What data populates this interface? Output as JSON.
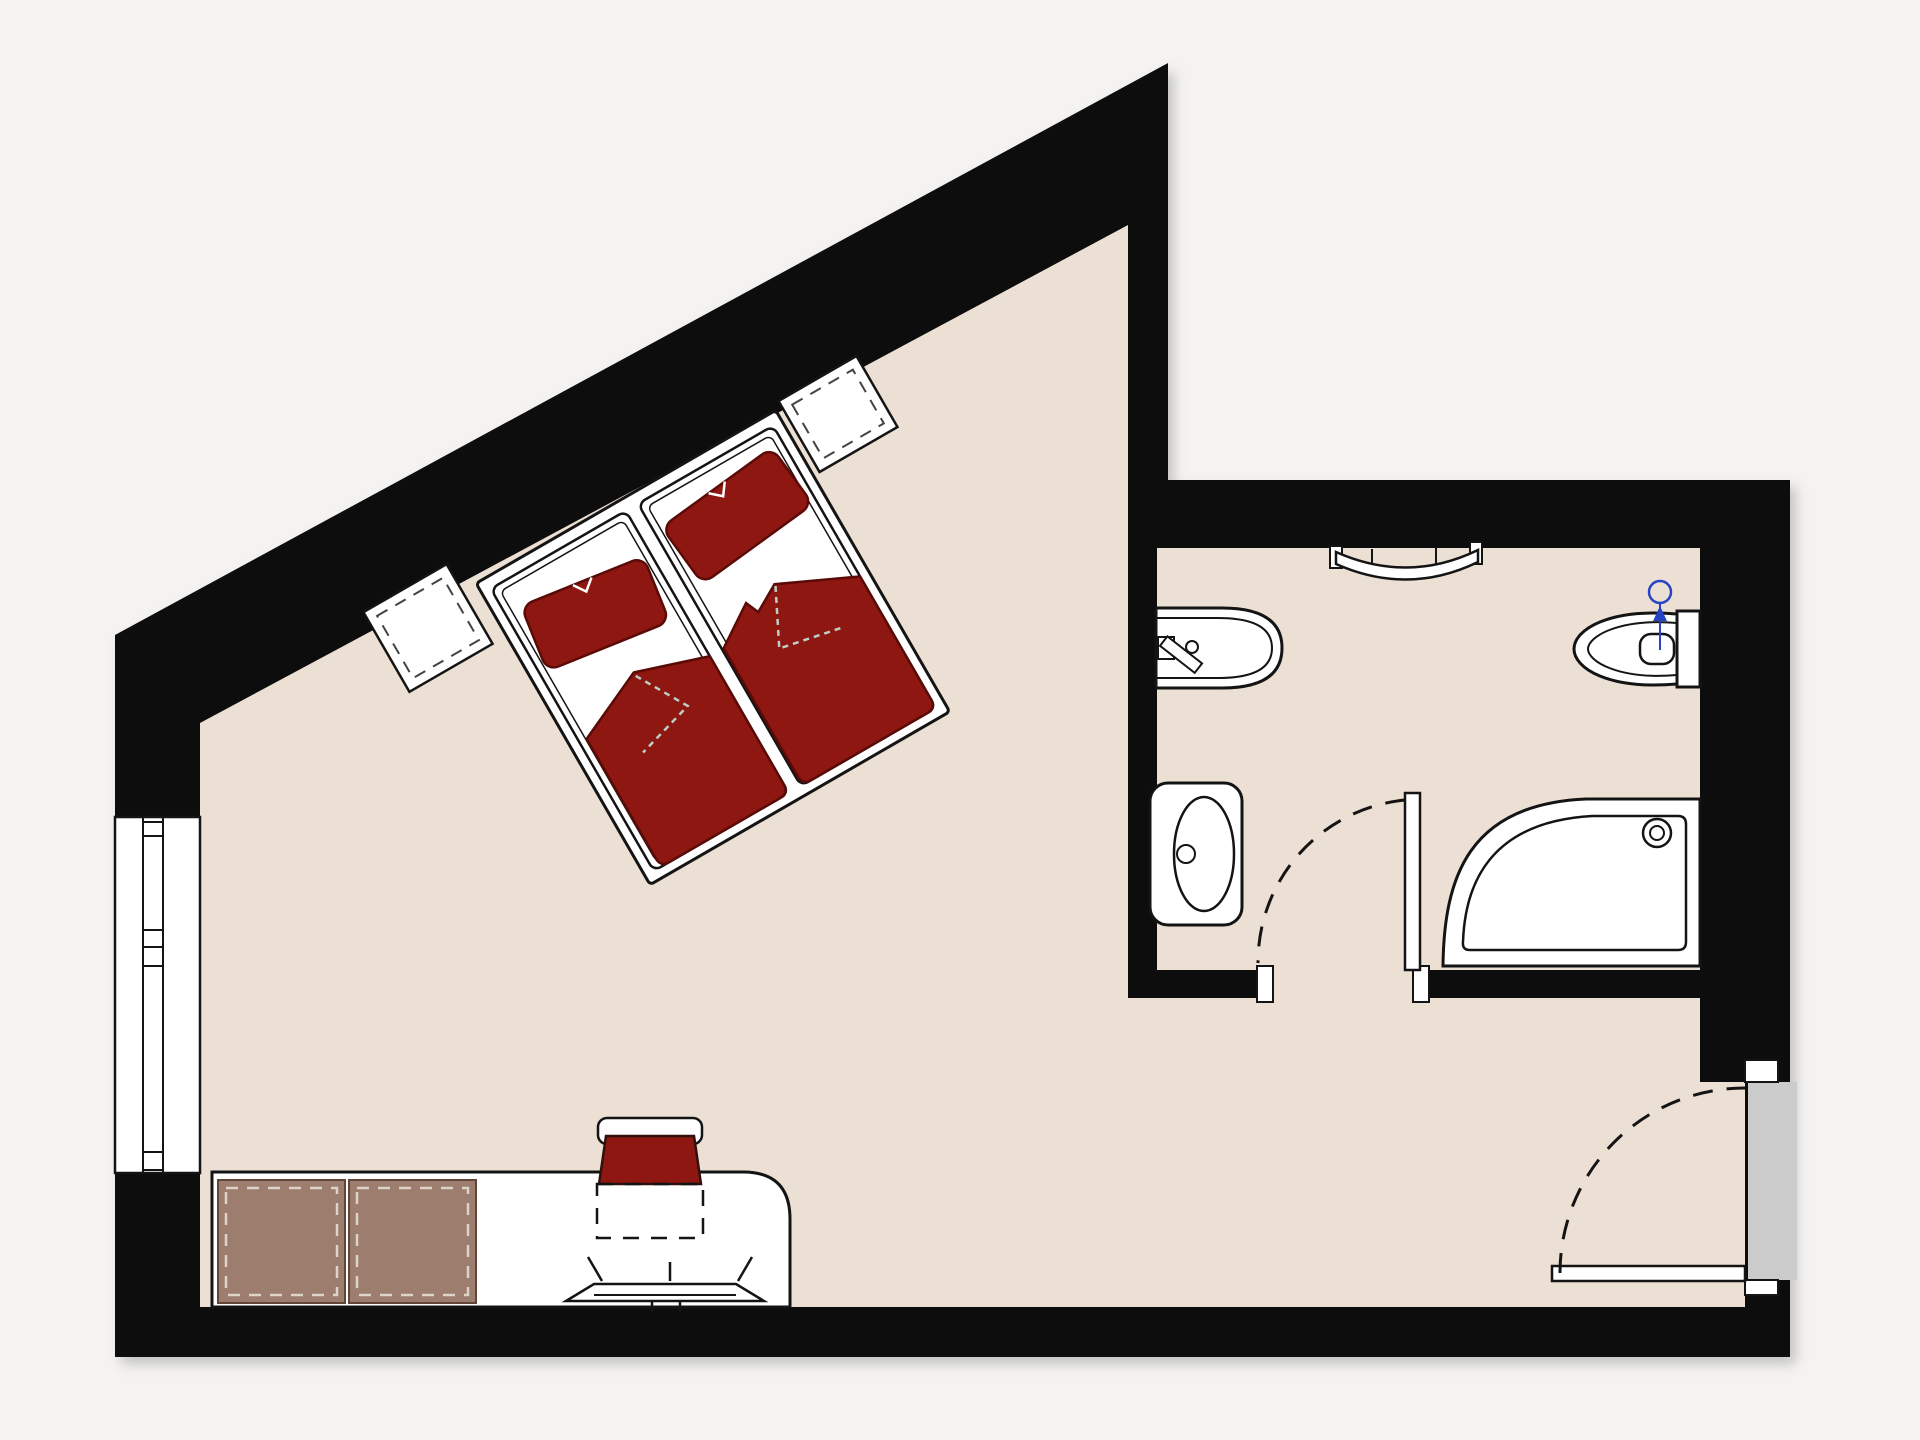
{
  "document": {
    "title": "Hotel room floor plan",
    "kind": "architectural-floor-plan",
    "visible_text": []
  },
  "colors": {
    "background": "#f4f3f1",
    "wall": "#0d0d0d",
    "floor": "#ecdfd3",
    "fixture_white": "#ffffff",
    "outline": "#141414",
    "textile_red": "#8e1712",
    "textile_red_border": "#5a0b07",
    "seam_light": "#bccfc7",
    "cabinet_brown": "#9c7d6e",
    "cabinet_border": "#5f4638",
    "cabinet_dash": "#ded3c9",
    "door_panel_gray": "#cbcbcb",
    "plumbing_blue": "#2743c5"
  },
  "rooms": {
    "bedroom": {
      "name": "sleeping-room",
      "furniture": [
        {
          "name": "double-bed",
          "parts": [
            "frame",
            "mattress-left",
            "mattress-right",
            "pillow-left",
            "pillow-right",
            "duvet-left",
            "duvet-right"
          ]
        },
        {
          "name": "nightstand-left"
        },
        {
          "name": "nightstand-right"
        },
        {
          "name": "sideboard",
          "sections": 2
        },
        {
          "name": "desk"
        },
        {
          "name": "chair"
        },
        {
          "name": "tv-on-wall-shelf"
        }
      ],
      "window": {
        "location": "left-exterior-wall",
        "style": "double-glazing-lines"
      }
    },
    "bathroom": {
      "name": "bathroom",
      "fixtures": [
        {
          "name": "bidet",
          "wall": "left"
        },
        {
          "name": "washbasin",
          "wall": "left"
        },
        {
          "name": "towel-radiator",
          "wall": "top"
        },
        {
          "name": "toilet",
          "wall": "right",
          "annotation": "blue water-supply symbol"
        },
        {
          "name": "quadrant-shower",
          "corner": "bottom-right"
        }
      ],
      "door": {
        "type": "hinged",
        "swing": "inward",
        "symbol": "dashed-quarter-arc"
      }
    },
    "entry": {
      "name": "entry-area",
      "door": {
        "type": "entrance-door",
        "location": "right-wall",
        "swing": "inward",
        "symbol": "dashed-quarter-arc",
        "panel": "gray-threshold-band"
      }
    }
  }
}
